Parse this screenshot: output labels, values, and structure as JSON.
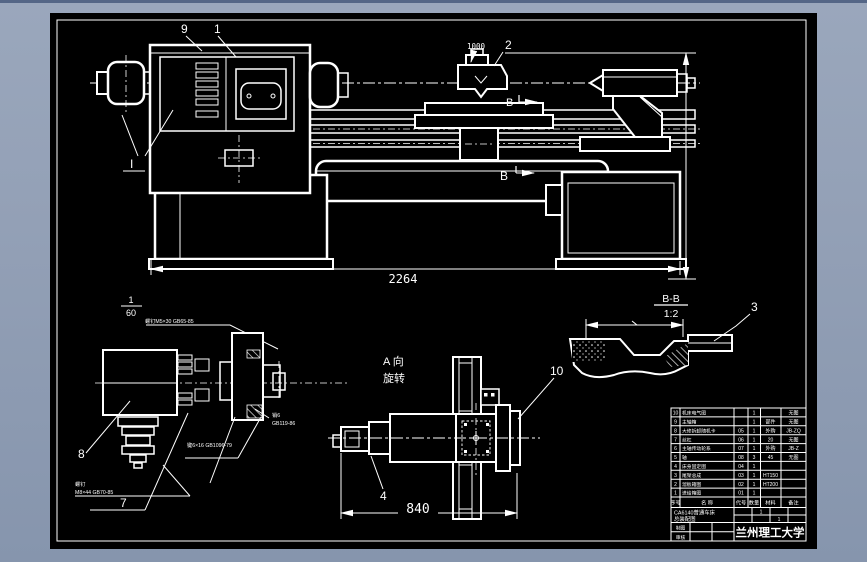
{
  "colors": {
    "window_background": "#93a0b6",
    "window_top_edge": "#546686",
    "canvas_background": "#000000",
    "ink": "#ffffff"
  },
  "main_view": {
    "label_9": "9",
    "label_1": "1",
    "label_I": "I",
    "label_2": "2",
    "label_B_upper": "B",
    "label_B_lower": "B",
    "dim_top": "1000",
    "dim_overall": "2264"
  },
  "detail_view": {
    "scale_numerator": "1",
    "scale_denominator": "60",
    "label_8": "8",
    "label_7": "7",
    "ann_top": "螺钉M5×30 GB65-85",
    "ann_key": "键6×16 GB1096-79",
    "ann_screw_line1": "螺钉",
    "ann_screw_line2": "M8×44 GB70-85",
    "ann_pin_line1": "销6",
    "ann_pin_line2": "GB119-86"
  },
  "a_view": {
    "caption_line1": "A 向",
    "caption_line2": "旋转",
    "label_10": "10",
    "label_4": "4",
    "dim_width": "840"
  },
  "bb_view": {
    "caption": "B-B",
    "scale": "1:2",
    "label_3": "3"
  },
  "title_block": {
    "parts": [
      {
        "seq": "10",
        "name": "机床电气图",
        "code": "",
        "qty": "1",
        "material": "",
        "remark": "无图"
      },
      {
        "seq": "9",
        "name": "主轴箱",
        "code": "",
        "qty": "1",
        "material": "部件",
        "remark": "无图"
      },
      {
        "seq": "8",
        "name": "大修拆卸随机卡",
        "code": "05",
        "qty": "1",
        "material": "外购",
        "remark": "JB-ZQ"
      },
      {
        "seq": "7",
        "name": "丝杠",
        "code": "06",
        "qty": "1",
        "material": "20",
        "remark": "无图"
      },
      {
        "seq": "6",
        "name": "主轴传动轮系",
        "code": "07",
        "qty": "1",
        "material": "外购",
        "remark": "JB-Z"
      },
      {
        "seq": "5",
        "name": "轴",
        "code": "08",
        "qty": "3",
        "material": "45",
        "remark": "无图"
      },
      {
        "seq": "4",
        "name": "床身固定图",
        "code": "04",
        "qty": "1",
        "material": "",
        "remark": ""
      },
      {
        "seq": "3",
        "name": "尾架总成",
        "code": "03",
        "qty": "1",
        "material": "HT150",
        "remark": ""
      },
      {
        "seq": "2",
        "name": "溜板箱图",
        "code": "02",
        "qty": "1",
        "material": "HT200",
        "remark": ""
      },
      {
        "seq": "1",
        "name": "进给箱图",
        "code": "01",
        "qty": "1",
        "material": "",
        "remark": ""
      }
    ],
    "header": {
      "seq": "序号",
      "name": "名 称",
      "code": "代号",
      "qty": "数量",
      "material": "材料",
      "remark": "备注"
    },
    "title_line1": "CA6140普通车床",
    "title_line2": "总装配图",
    "meta_mark1": "1",
    "meta_mark2": "1",
    "sig_label1": "制图",
    "sig_label2": "审核",
    "school": "兰州理工大学"
  }
}
